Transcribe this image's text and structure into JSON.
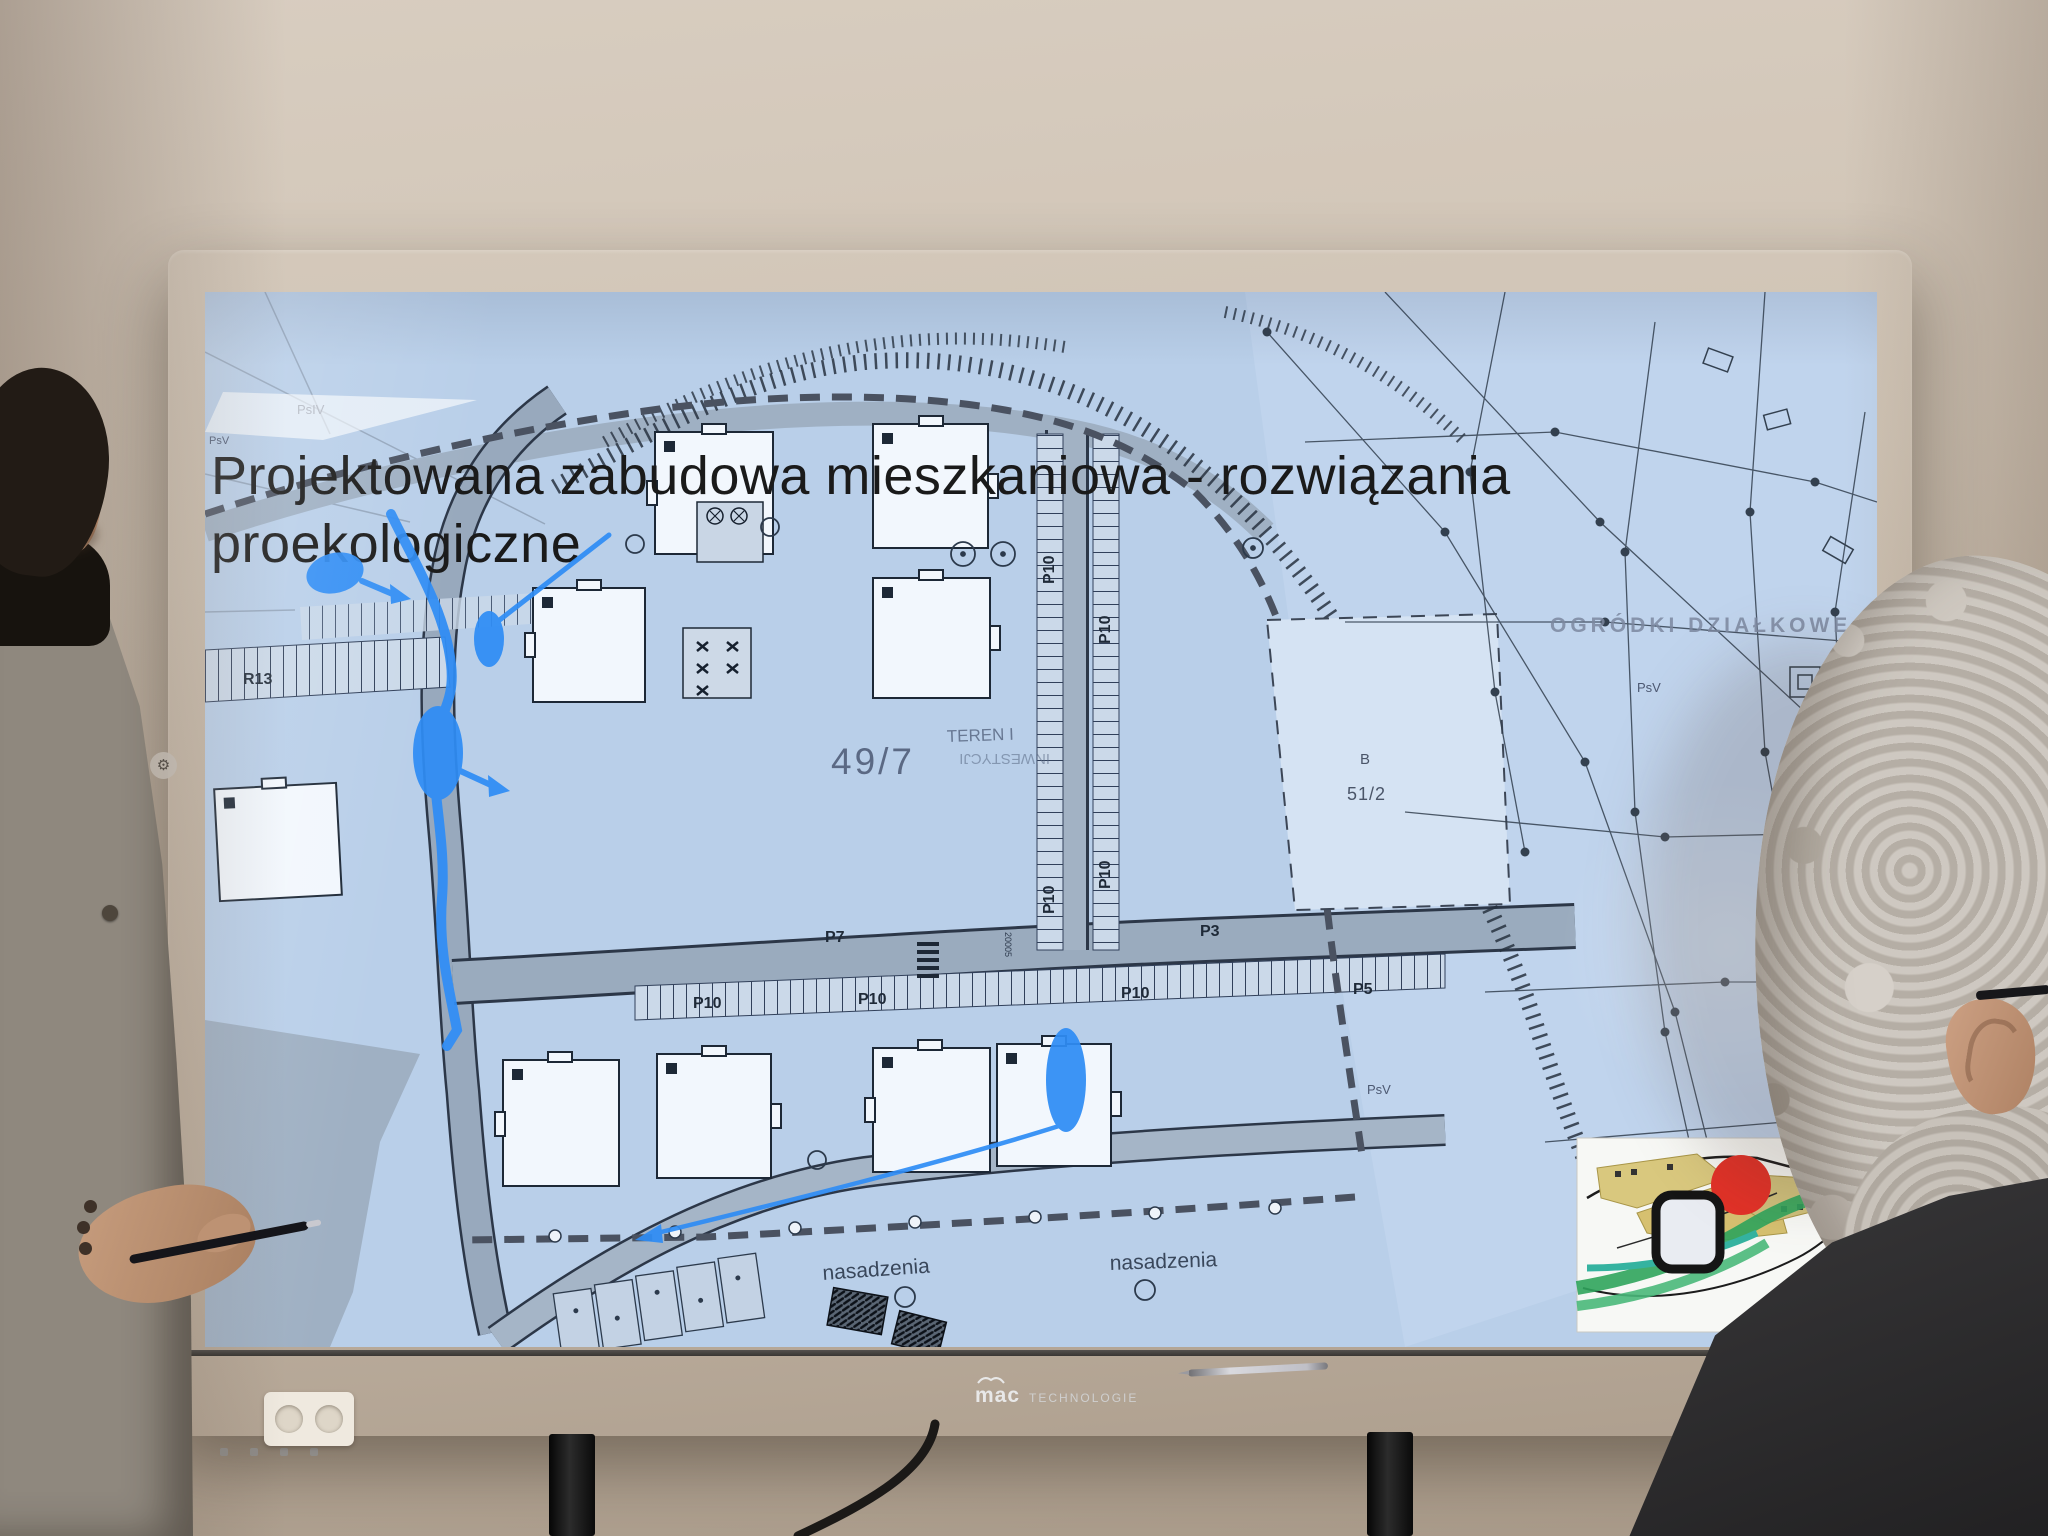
{
  "slide": {
    "title_line1": "Projektowana zabudowa mieszkaniowa - rozwiązania",
    "title_line2": "proekologiczne"
  },
  "map_labels": {
    "psiv": "PsIV",
    "psv": "PsV",
    "allotments": "OGRÓDKI DZIAŁKOWE",
    "parcel_letter": "B",
    "parcel_number": "51/2",
    "plot_number": "49/7",
    "teren": "TEREN I",
    "teren_rotated": "INWESTYCJI",
    "r13": "R13",
    "p7": "P7",
    "p3": "P3",
    "p10": "P10",
    "p5": "P5",
    "dim": "20005",
    "nasadzenia": "nasadzenia"
  },
  "tv": {
    "brand": "mac",
    "brand_suffix": "TECHNOLOGIE"
  },
  "icons": {
    "gear": "⚙"
  },
  "colors": {
    "annotation_blue": "#2f8df5",
    "inset_marker_red": "#e23127",
    "map_background": "#b9cfe9",
    "inset_green": "#2fa45c",
    "inset_teal": "#35b3a0",
    "inset_sand": "#d9c87e",
    "wall": "#cfc3b4",
    "bezel": "#141312"
  }
}
